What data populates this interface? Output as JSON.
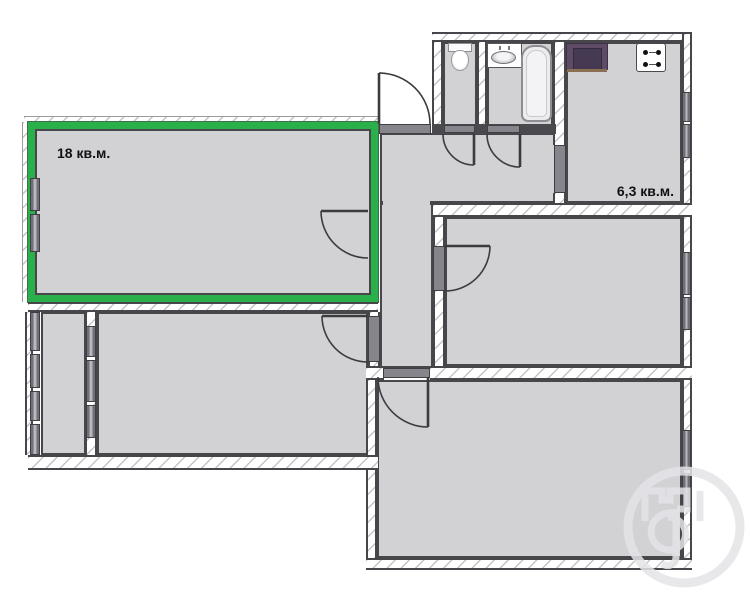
{
  "plan": {
    "title": "apartment-floor-plan",
    "rooms": {
      "living": {
        "name": "highlighted-room",
        "area_label": "18 кв.м.",
        "highlighted": true
      },
      "kitchen": {
        "name": "kitchen",
        "area_label": "6,3 кв.м."
      },
      "wc": {
        "name": "wc"
      },
      "bathroom": {
        "name": "bathroom"
      },
      "hall": {
        "name": "hallway"
      },
      "room_middle_right": {
        "name": "room"
      },
      "room_bottom": {
        "name": "room"
      },
      "room_middle_left": {
        "name": "room"
      },
      "balcony": {
        "name": "balcony"
      }
    },
    "fixtures": [
      "toilet-icon",
      "sink-icon",
      "bathtub-icon",
      "stove-icon",
      "kitchen-counter"
    ],
    "colors": {
      "highlight_green": "#2ab04a",
      "room_fill": "#d2d2d4",
      "wall_line": "#47474b",
      "window_band": "#6f6f75",
      "counter_purple": "#5e4c66",
      "label_text": "#111114"
    },
    "watermark": "agency-logo-monogram"
  }
}
